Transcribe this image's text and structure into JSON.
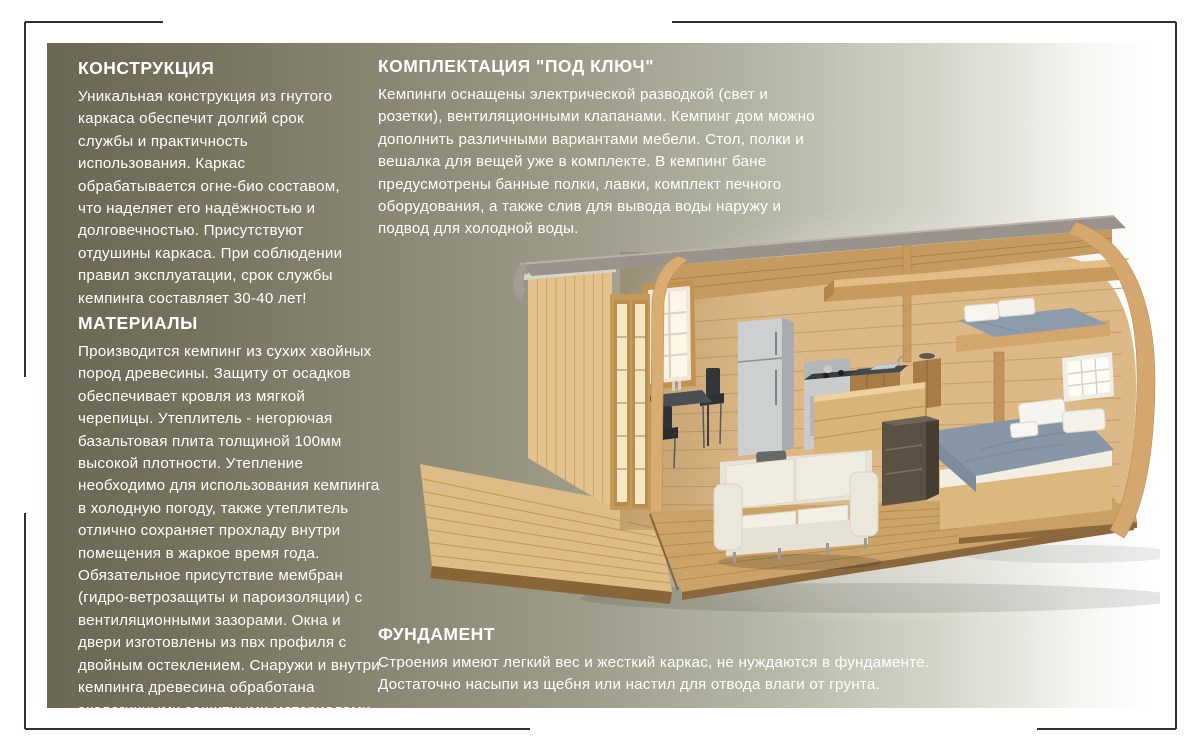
{
  "page": {
    "background": "#ffffff",
    "panel": {
      "gradient_left": "#6a6854",
      "gradient_right": "#ffffff"
    },
    "frame_color": "#31312a",
    "text_color": "#ffffff"
  },
  "sections": {
    "construction": {
      "title": "КОНСТРУКЦИЯ",
      "body": "Уникальная конструкция из гнутого\nкаркаса обеспечит долгий срок\nслужбы и практичность\nиспользования. Каркас\nобрабатывается огне-био составом,\nчто наделяет его надёжностью и\nдолговечностью. Присутствуют\nотдушины каркаса. При соблюдении\nправил эксплуатации, срок службы\nкемпинга составляет 30-40 лет!"
    },
    "materials": {
      "title": "МАТЕРИАЛЫ",
      "body": "Производится кемпинг из сухих хвойных\nпород древесины. Защиту от осадков\nобеспечивает кровля из мягкой\nчерепицы.  Утеплитель - негорючая\nбазальтовая плита толщиной 100мм\nвысокой плотности. Утепление\nнеобходимо для использования кемпинга\nв холодную погоду, также утеплитель\nотлично сохраняет прохладу внутри\nпомещения в жаркое время года.\nОбязательное присутствие мембран\n(гидро-ветрозащиты и пароизоляции) с\nвентиляционными зазорами. Окна и\nдвери изготовлены из пвх профиля с\nдвойным остеклением. Снаружи и внутри\nкемпинга древесина обработана\nэкологичными  защитными материалами."
    },
    "turnkey": {
      "title": "КОМПЛЕКТАЦИЯ \"ПОД КЛЮЧ\"",
      "body": "Кемпинги оснащены электрической разводкой (свет и\nрозетки), вентиляционными клапанами. Кемпинг дом можно\nдополнить различными вариантами мебели. Стол, полки и\nвешалка для вещей уже в комплекте. В кемпинг бане\nпредусмотрены банные полки, лавки, комплект печного\nоборудования, а также слив для вывода воды наружу и\nподвод для холодной воды."
    },
    "foundation": {
      "title": "ФУНДАМЕНТ",
      "body": "Строения имеют легкий вес и жесткий каркас, не нуждаются в фундаменте.\nДостаточно насыпи из щебня или настил для отвода влаги от грунта."
    }
  },
  "illustration": {
    "description": "3D cutaway render of an arched wooden camping house with porch, glazed door, kitchen, dining table, sofa, double bed and loft bunk",
    "wood_color": "#ddb988",
    "roof_color": "#9a938b",
    "bedding_color": "#8897a5"
  }
}
